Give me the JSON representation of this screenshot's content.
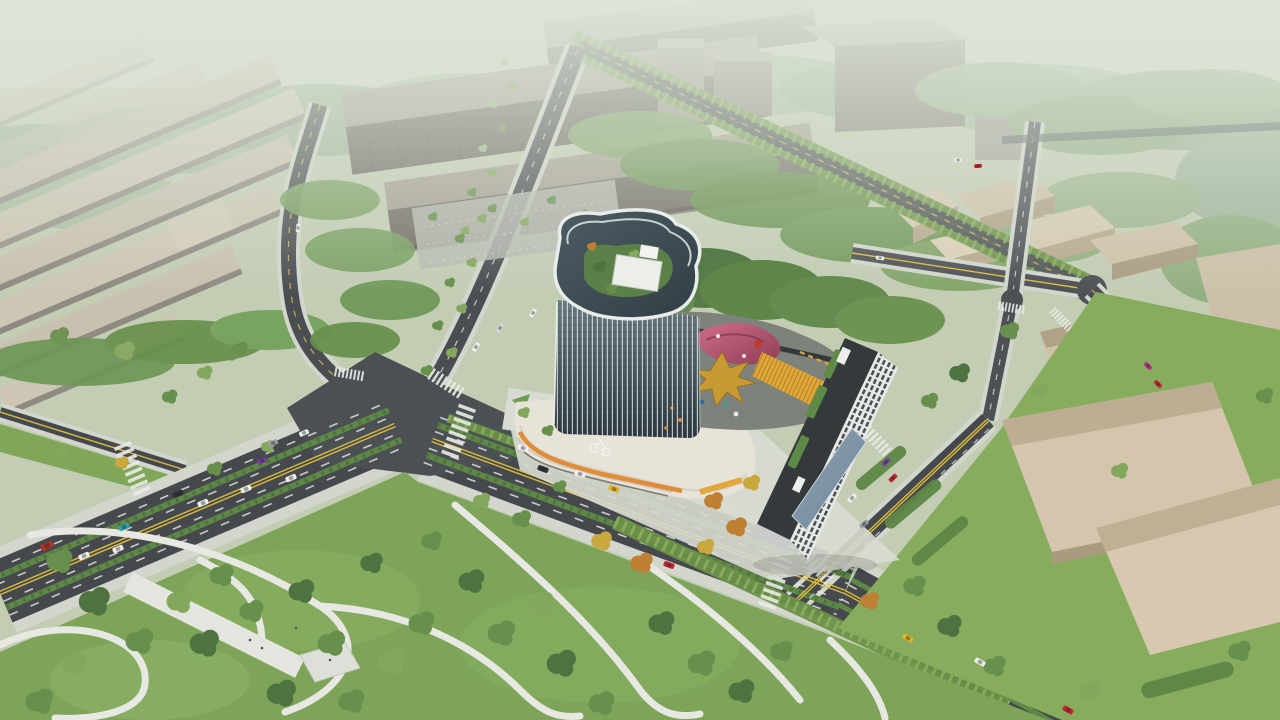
{
  "scene": {
    "type": "architectural-aerial-rendering",
    "description": "Daytime aerial rendering of a mixed-use development: a curved glass office tower with rooftop garden on a retail podium with a colorful play deck (gold leaf sculpture, pink canopy), a white residential slab beside it, set at a large road intersection with tree-lined boulevards, a landscaped park with winding paths, rows of industrial warehouses to the left, a large gray office complex and low tan campus buildings in the hazy distance, and small cars on every street.",
    "visible_text": [],
    "objects": [
      {
        "name": "glass-tower",
        "label": "curved glass office tower with rooftop garden"
      },
      {
        "name": "retail-podium",
        "label": "white banded podium with orange stripe"
      },
      {
        "name": "play-deck",
        "label": "rooftop play deck with gold leaf sculpture and pink canopy"
      },
      {
        "name": "residential-building",
        "label": "white residential slab with green roof"
      },
      {
        "name": "main-boulevard",
        "label": "multi-lane boulevard with green medians"
      },
      {
        "name": "intersection-plaza",
        "label": "large asphalt intersection"
      },
      {
        "name": "city-park",
        "label": "park with winding white paths"
      },
      {
        "name": "warehouse-district",
        "label": "rows of tan warehouse roofs"
      },
      {
        "name": "office-complex",
        "label": "large gray office blocks"
      },
      {
        "name": "campus-buildings",
        "label": "tan low-rise campus cluster"
      },
      {
        "name": "cars",
        "label": "assorted cars on roads"
      }
    ]
  },
  "palette": {
    "sky_top": "#c3cfc0",
    "sky_bottom": "#dde4d6",
    "haze": "#dfe6da",
    "ground": "#c3cdb4",
    "grass_park": "#7da459",
    "grass_lawn": "#87ac5e",
    "forest_dark": "#4e7540",
    "forest_mid": "#6e9757",
    "forest_light": "#9cb48c",
    "asphalt": "#45494d",
    "asphalt_plaza": "#4b5054",
    "asphalt_far": "#4d5156",
    "marking_yellow": "#e2c23c",
    "marking_white": "#e9ebe6",
    "sidewalk": "#d2d6cc",
    "park_path": "#e6e8e1",
    "median_green": "#5f8746",
    "warehouse_roof": "#c9c1b0",
    "warehouse_face": "#97928a",
    "office_roof": "#a69f94",
    "office_face": "#6e6a64",
    "campus_roof": "#d6cab2",
    "campus_face": "#b7a98e",
    "tower_glass_dark": "#2c383f",
    "tower_glass_light": "#6b7d82",
    "tower_fin": "#e8ecea",
    "podium_white": "#e7e3d9",
    "podium_orange": "#e0882e",
    "podium_amber": "#e0a83c",
    "deck_gray": "#7d827a",
    "canopy_pink_light": "#d06f8a",
    "canopy_pink_dark": "#8f3d56",
    "leaf_gold": "#c79a33",
    "residential_wall": "#e9ebe9",
    "residential_window": "#383e41",
    "residential_roof": "#34393c",
    "roof_garden": "#5b8148",
    "entrance_canopy": "#6d8498",
    "car_white": "#f0f1ee",
    "car_black": "#2e3234",
    "car_gray": "#9aa0a3",
    "car_red": "#c22430",
    "car_teal": "#2ea6a0",
    "car_yellow": "#e3b428",
    "car_purple": "#7b3f9e",
    "car_magenta": "#b2327e"
  }
}
